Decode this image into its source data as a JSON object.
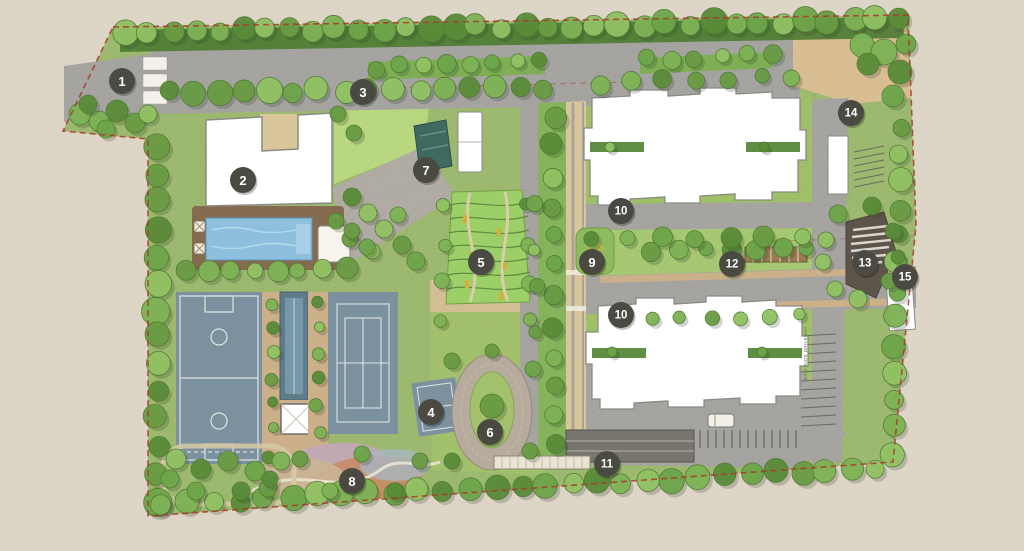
{
  "plan": {
    "markers": [
      {
        "label": "1",
        "x": 122,
        "y": 81
      },
      {
        "label": "2",
        "x": 243,
        "y": 180
      },
      {
        "label": "3",
        "x": 363,
        "y": 92
      },
      {
        "label": "4",
        "x": 431,
        "y": 412
      },
      {
        "label": "5",
        "x": 481,
        "y": 262
      },
      {
        "label": "6",
        "x": 490,
        "y": 432
      },
      {
        "label": "7",
        "x": 426,
        "y": 170
      },
      {
        "label": "8",
        "x": 352,
        "y": 481
      },
      {
        "label": "9",
        "x": 592,
        "y": 262
      },
      {
        "label": "10",
        "x": 621,
        "y": 211
      },
      {
        "label": "10",
        "x": 621,
        "y": 315
      },
      {
        "label": "11",
        "x": 607,
        "y": 464
      },
      {
        "label": "12",
        "x": 732,
        "y": 264
      },
      {
        "label": "13",
        "x": 865,
        "y": 263
      },
      {
        "label": "14",
        "x": 851,
        "y": 113
      },
      {
        "label": "15",
        "x": 905,
        "y": 277
      }
    ],
    "annotations": {
      "driveway": {
        "text": "3.0M WIDE DRIVEWAY"
      }
    },
    "palette": {
      "background": "#ddd5c6",
      "landscape": "#9cb96f",
      "lawn": "#b9d77f",
      "hedge": "#4e7c33",
      "road": "#a5a4a0",
      "path": "#d9c79b",
      "parking": "#cbb089",
      "building": "#ffffff",
      "building_stroke": "#8a8a84",
      "court": "#7b91a0",
      "court_line": "#dfe4e0",
      "pool": "#8ec0dd",
      "lap_pool": "#5e7c89",
      "deck": "#856b50",
      "oval_ring": "#b6ab9c",
      "amphitheater": "#5e554a",
      "marker": "#4a4a43",
      "marker_text": "#ffffff",
      "boundary": "#a83a2a"
    }
  }
}
